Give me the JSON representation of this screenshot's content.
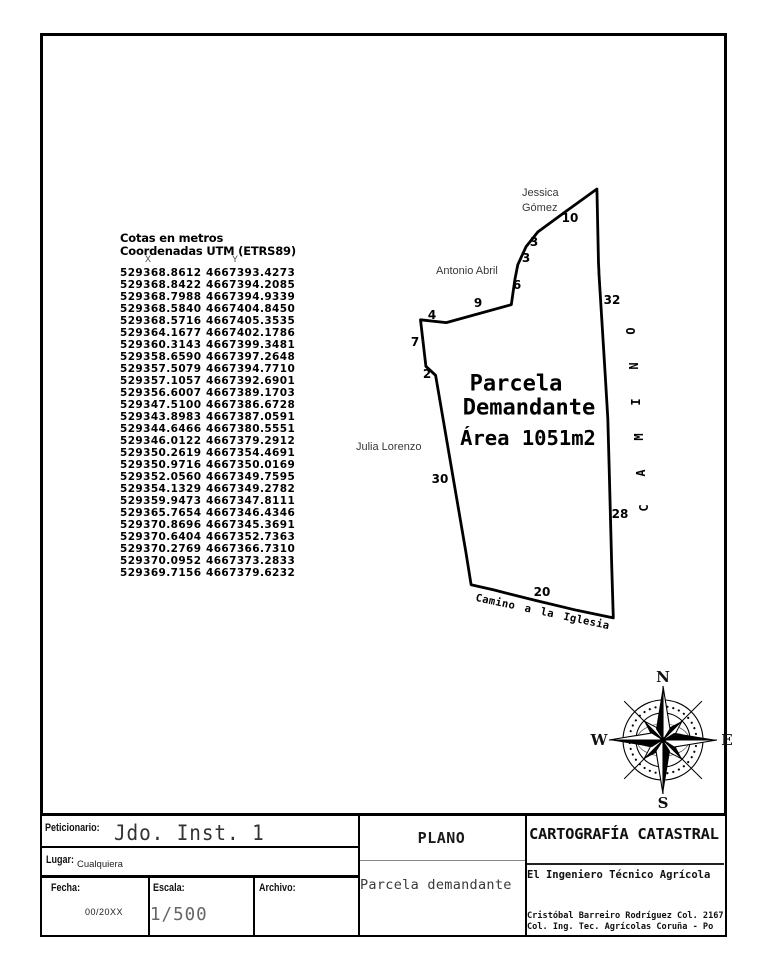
{
  "coordinates": {
    "title1": "Cotas en metros",
    "title2": "Coordenadas UTM (ETRS89)",
    "col_x": "X",
    "col_y": "Y",
    "rows": [
      [
        "529368.8612",
        "4667393.4273"
      ],
      [
        "529368.8422",
        "4667394.2085"
      ],
      [
        "529368.7988",
        "4667394.9339"
      ],
      [
        "529368.5840",
        "4667404.8450"
      ],
      [
        "529368.5716",
        "4667405.3535"
      ],
      [
        "529364.1677",
        "4667402.1786"
      ],
      [
        "529360.3143",
        "4667399.3481"
      ],
      [
        "529358.6590",
        "4667397.2648"
      ],
      [
        "529357.5079",
        "4667394.7710"
      ],
      [
        "529357.1057",
        "4667392.6901"
      ],
      [
        "529356.6007",
        "4667389.1703"
      ],
      [
        "529347.5100",
        "4667386.6728"
      ],
      [
        "529343.8983",
        "4667387.0591"
      ],
      [
        "529344.6466",
        "4667380.5551"
      ],
      [
        "529346.0122",
        "4667379.2912"
      ],
      [
        "529350.2619",
        "4667354.4691"
      ],
      [
        "529350.9716",
        "4667350.0169"
      ],
      [
        "529352.0560",
        "4667349.7595"
      ],
      [
        "529354.1329",
        "4667349.2782"
      ],
      [
        "529359.9473",
        "4667347.8111"
      ],
      [
        "529365.7654",
        "4667346.4346"
      ],
      [
        "529370.8696",
        "4667345.3691"
      ],
      [
        "529370.6404",
        "4667352.7363"
      ],
      [
        "529370.2769",
        "4667366.7310"
      ],
      [
        "529370.0952",
        "4667373.2833"
      ],
      [
        "529369.7156",
        "4667379.6232"
      ]
    ]
  },
  "drawing": {
    "parcel_label_lines": [
      "Parcela",
      "Demandante",
      "Área 1051m2"
    ],
    "edge_labels": [
      {
        "text": "10",
        "x": 570,
        "y": 218
      },
      {
        "text": "3",
        "x": 534,
        "y": 242
      },
      {
        "text": "3",
        "x": 526,
        "y": 258
      },
      {
        "text": "6",
        "x": 517,
        "y": 285
      },
      {
        "text": "9",
        "x": 478,
        "y": 303
      },
      {
        "text": "4",
        "x": 432,
        "y": 315
      },
      {
        "text": "7",
        "x": 415,
        "y": 342
      },
      {
        "text": "2",
        "x": 427,
        "y": 374
      },
      {
        "text": "30",
        "x": 440,
        "y": 479
      },
      {
        "text": "20",
        "x": 542,
        "y": 592
      },
      {
        "text": "28",
        "x": 620,
        "y": 514
      },
      {
        "text": "32",
        "x": 612,
        "y": 300
      }
    ],
    "neighbor_labels": [
      {
        "lines": [
          "Jessica",
          "Gómez"
        ],
        "x": 522,
        "y": 186
      },
      {
        "lines": [
          "Antonio Abril"
        ],
        "x": 436,
        "y": 264
      },
      {
        "lines": [
          "Julia Lorenzo"
        ],
        "x": 356,
        "y": 440
      }
    ],
    "road_label_right": "CAMINO",
    "road_label_bottom": "Camino a la Iglesia",
    "line_color": "#000000"
  },
  "compass": {
    "north": "N",
    "south": "S",
    "east": "E",
    "west": "W"
  },
  "title_block": {
    "peticionario_label": "Peticionario:",
    "peticionario_value": "Jdo. Inst. 1",
    "lugar_label": "Lugar:",
    "lugar_value": "Cualquiera",
    "fecha_label": "Fecha:",
    "fecha_value": "00/20XX",
    "escala_label": "Escala:",
    "escala_value": "1/500",
    "archivo_label": "Archivo:",
    "plano_label": "PLANO",
    "plano_value": "Parcela demandante",
    "cartografia_title": "CARTOGRAFÍA CATASTRAL",
    "engineer_title": "El Ingeniero Técnico Agrícola",
    "credit_line1": "Cristóbal Barreiro Rodríguez Col. 2167",
    "credit_line2": "Col. Ing. Tec. Agrícolas Coruña - Po"
  }
}
